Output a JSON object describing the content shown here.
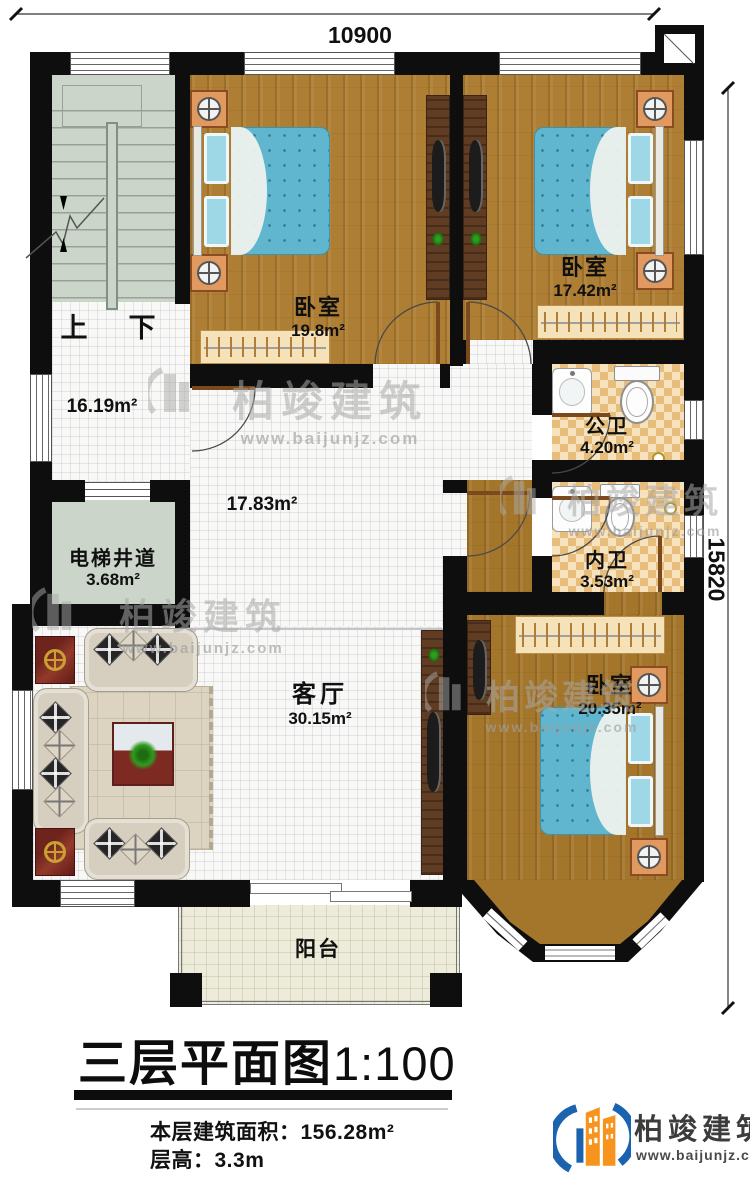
{
  "title": {
    "plan": "三层平面图",
    "scale": "1:100"
  },
  "info": {
    "area_label": "本层建筑面积：",
    "area_value": "156.28m²",
    "floor_height_label": "层高：",
    "floor_height_value": "3.3m"
  },
  "dimensions": {
    "width": "10900",
    "height": "15820"
  },
  "rooms": {
    "bedroom1": {
      "name": "卧室",
      "area": "19.8m²"
    },
    "bedroom2": {
      "name": "卧室",
      "area": "17.42m²"
    },
    "bedroom3": {
      "name": "卧室",
      "area": "20.35m²"
    },
    "hall": {
      "area": "16.19m²"
    },
    "corridor": {
      "area": "17.83m²"
    },
    "living": {
      "name": "客厅",
      "area": "30.15m²"
    },
    "elevator": {
      "name": "电梯井道",
      "area": "3.68m²"
    },
    "public_bath": {
      "name": "公卫",
      "area": "4.20m²"
    },
    "ensuite_bath": {
      "name": "内卫",
      "area": "3.53m²"
    },
    "balcony": {
      "name": "阳台"
    }
  },
  "stairs": {
    "up": "上",
    "down": "下"
  },
  "brand": {
    "name": "柏竣建筑",
    "website": "www.baijunjz.com"
  },
  "colors": {
    "wall": "#0e0e0e",
    "wood_floor": "#ad7e33",
    "tile_floor": "#f8f8f6",
    "stair_floor": "#ccd5ca",
    "bath_checker_light": "#f6e3bd",
    "bath_checker_dark": "#e7bd7c",
    "bed_blue": "#5fb6ce",
    "balcony_floor": "#edebd9",
    "logo_blue": "#1b63ae",
    "logo_orange": "#f7941d"
  }
}
